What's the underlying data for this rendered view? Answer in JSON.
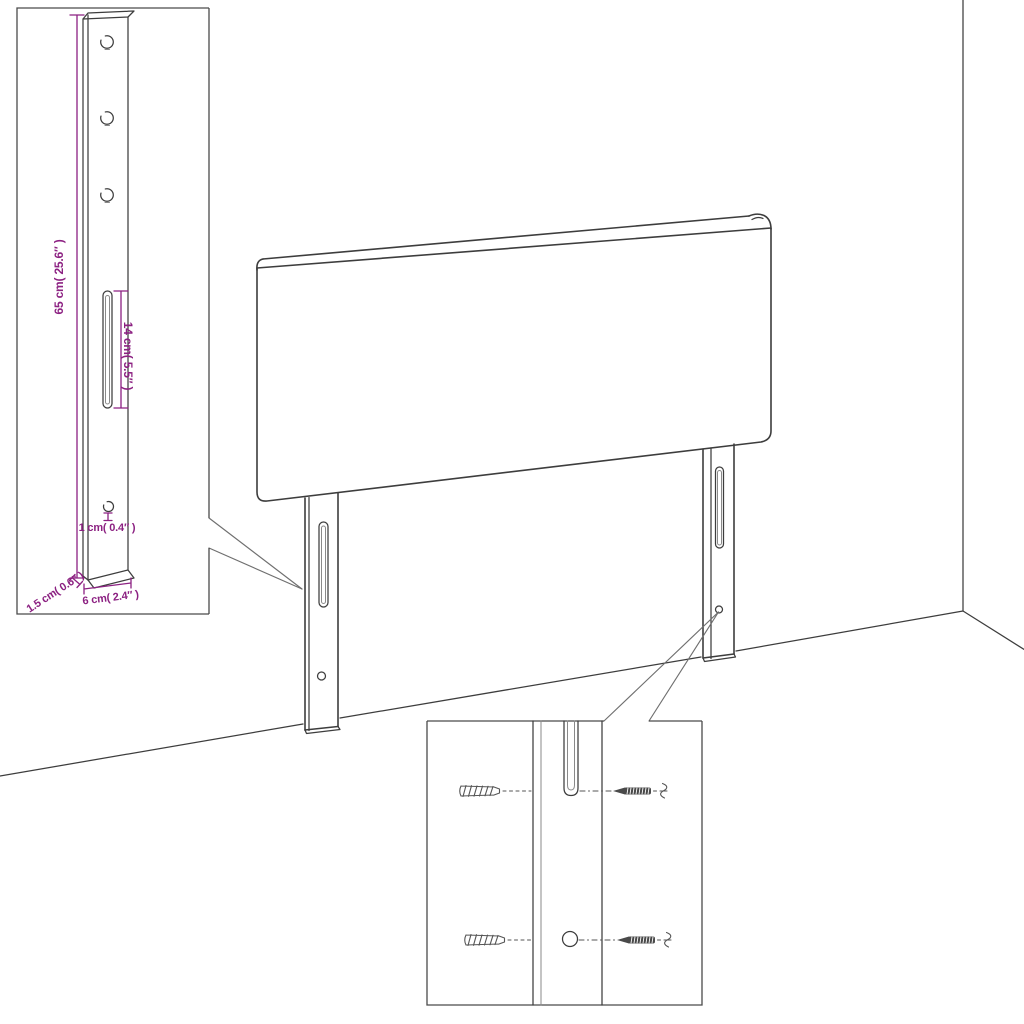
{
  "colors": {
    "line": "#3d3d3d",
    "box_border": "#4a4a4a",
    "dimension": "#8C2182",
    "background": "#ffffff"
  },
  "leg_detail_inset": {
    "dimensions": {
      "height": "65 cm( 25.6″ )",
      "slot_length": "14 cm( 5.5″ )",
      "hole_diameter": "1 cm( 0.4″ )",
      "thickness": "1.5 cm( 0.6″ )",
      "width": "6 cm( 2.4″ )"
    }
  }
}
